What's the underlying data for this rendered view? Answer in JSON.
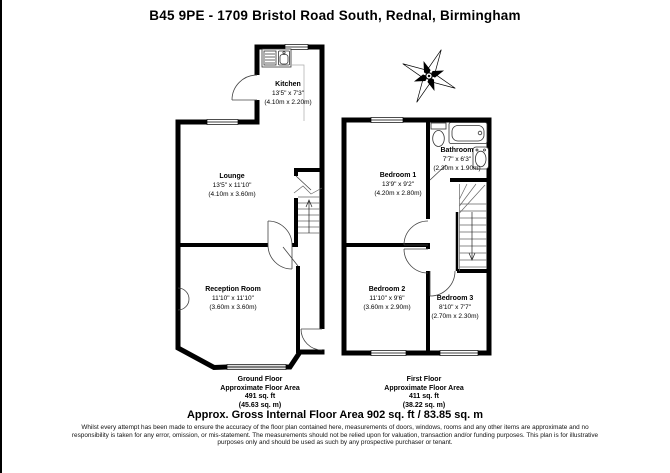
{
  "title": "B45 9PE - 1709 Bristol Road South, Rednal, Birmingham",
  "ground_floor": {
    "caption": {
      "floor_name": "Ground Floor",
      "area_label": "Approximate Floor Area",
      "area_imperial": "491 sq. ft",
      "area_metric": "(45.63 sq. m)"
    },
    "rooms": {
      "kitchen": {
        "name": "Kitchen",
        "size_imperial": "13'5\" x 7'3\"",
        "size_metric": "(4.10m x 2.20m)"
      },
      "lounge": {
        "name": "Lounge",
        "size_imperial": "13'5\" x 11'10\"",
        "size_metric": "(4.10m x 3.60m)"
      },
      "reception": {
        "name": "Reception Room",
        "size_imperial": "11'10\" x 11'10\"",
        "size_metric": "(3.60m x 3.60m)"
      }
    }
  },
  "first_floor": {
    "caption": {
      "floor_name": "First Floor",
      "area_label": "Approximate Floor Area",
      "area_imperial": "411 sq. ft",
      "area_metric": "(38.22 sq. m)"
    },
    "rooms": {
      "bedroom1": {
        "name": "Bedroom 1",
        "size_imperial": "13'9\" x 9'2\"",
        "size_metric": "(4.20m x 2.80m)"
      },
      "bathroom": {
        "name": "Bathroom",
        "size_imperial": "7'7\" x 6'3\"",
        "size_metric": "(2.30m x 1.90m)"
      },
      "bedroom2": {
        "name": "Bedroom 2",
        "size_imperial": "11'10\" x 9'6\"",
        "size_metric": "(3.60m x 2.90m)"
      },
      "bedroom3": {
        "name": "Bedroom 3",
        "size_imperial": "8'10\" x 7'7\"",
        "size_metric": "(2.70m x 2.30m)"
      }
    }
  },
  "summary": "Approx. Gross Internal Floor Area 902 sq. ft / 83.85 sq. m",
  "disclaimer": "Whilst every attempt has been made to ensure the accuracy of the floor plan contained here, measurements of doors, windows, rooms and any other items are approximate and no responsibility is taken for any error, omission, or mis-statement. The measurements should not be relied upon for valuation, transaction and/or funding purposes. This plan is for illustrative purposes only and should be used as such by any prospective purchaser or tenant.",
  "colors": {
    "wall": "#000000",
    "background": "#ffffff",
    "fixture": "#444444"
  }
}
